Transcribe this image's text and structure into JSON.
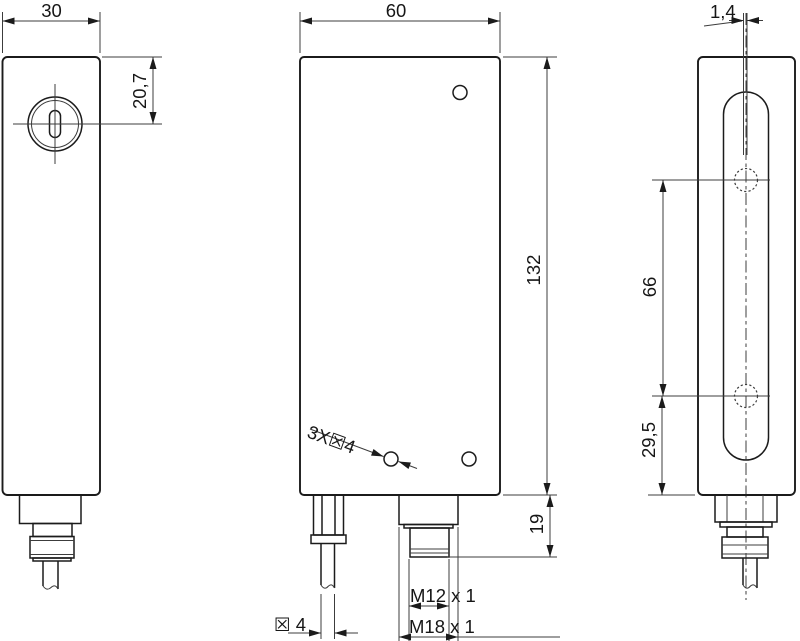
{
  "drawing_labels": {
    "left_view": {
      "width": "30",
      "emitter_offset": "20,7"
    },
    "front_view": {
      "width": "60",
      "height": "132",
      "connector_length": "19",
      "mounting_holes": "3X☒4",
      "cable_diameter": "☒ 4",
      "thread_m12": "M12 x 1",
      "thread_m18": "M18 x 1"
    },
    "side_view": {
      "slit_width": "1,4",
      "hole_spacing": "66",
      "hole_offset_bottom": "29,5"
    }
  },
  "colors": {
    "outline": "#1b1b1b",
    "thin_line": "#3c3c3c",
    "background": "#ffffff"
  }
}
